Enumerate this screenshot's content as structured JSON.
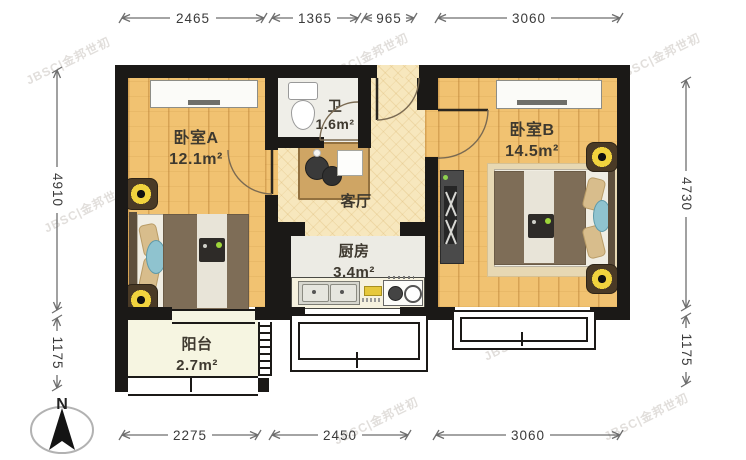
{
  "watermark": {
    "text": "JBSC|金邦世初"
  },
  "rooms": {
    "bedroomA": {
      "name": "卧室A",
      "area": "12.1m²"
    },
    "bathroom": {
      "name": "卫",
      "area": "1.6m²"
    },
    "living": {
      "name": "客厅"
    },
    "kitchen": {
      "name": "厨房",
      "area": "3.4m²"
    },
    "bedroomB": {
      "name": "卧室B",
      "area": "14.5m²"
    },
    "balcony": {
      "name": "阳台",
      "area": "2.7m²"
    }
  },
  "dimensions": {
    "top": [
      "2465",
      "1365",
      "965",
      "3060"
    ],
    "bottom": [
      "2275",
      "2450",
      "3060"
    ],
    "left": [
      "4910",
      "1175"
    ],
    "right": [
      "4730",
      "1175"
    ]
  },
  "compass": {
    "north_label": "N"
  },
  "colors": {
    "wall": "#1b1917",
    "wood_floor": "#f1c271",
    "living_floor": "#f7e7bd",
    "dimension_text": "#3b3b3b",
    "lamp_ring": "#f1d33e"
  }
}
